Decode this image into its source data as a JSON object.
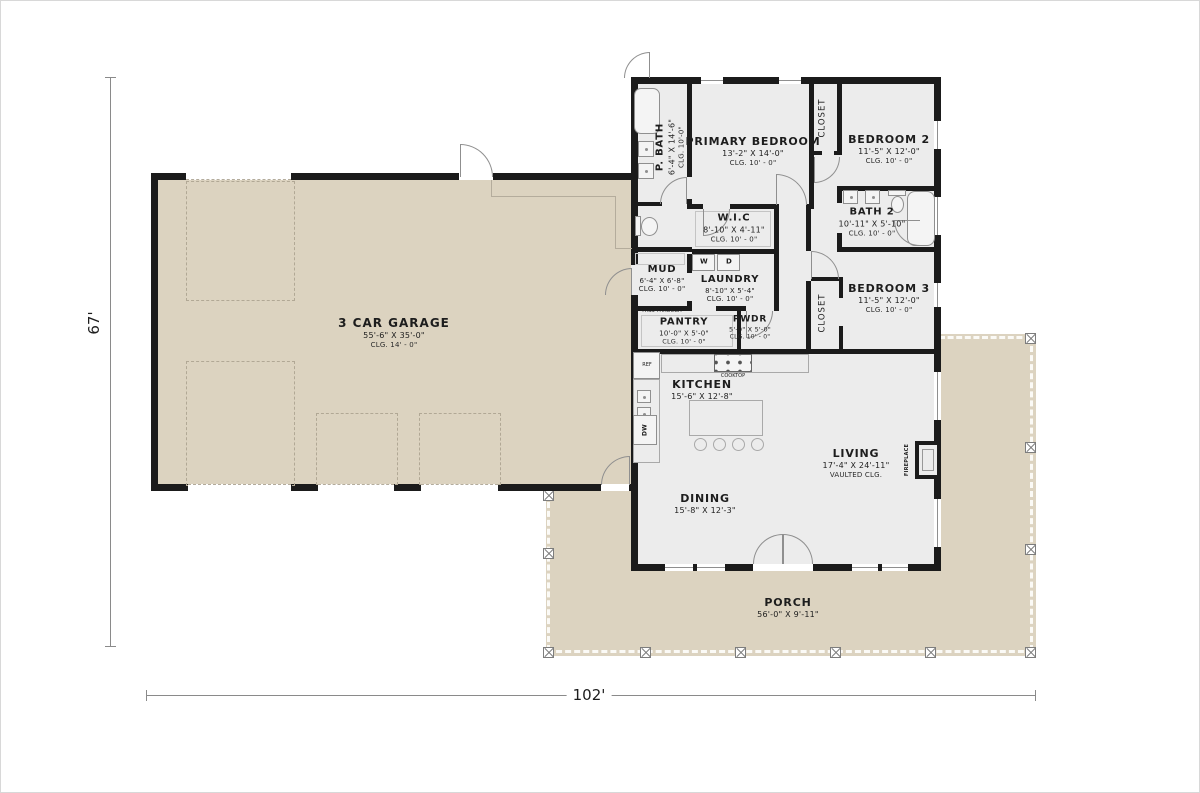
{
  "colors": {
    "wall": "#1b1b1b",
    "garage_fill": "#dcd3c0",
    "house_fill": "#ececec",
    "porch_fill": "#dcd3c0",
    "fixture_line": "#8f8f8f"
  },
  "dimensions": {
    "height_label": "67'",
    "width_label": "102'"
  },
  "rooms": {
    "garage": {
      "name": "3 CAR GARAGE",
      "size": "55'-6\" X 35'-0\"",
      "ceiling": "CLG. 14' - 0\""
    },
    "primary_bedroom": {
      "name": "PRIMARY BEDROOM",
      "size": "13'-2\" X 14'-0\"",
      "ceiling": "CLG. 10' - 0\""
    },
    "p_bath": {
      "name": "P. BATH",
      "size": "6'-4\" X 14'-6\"",
      "ceiling": "CLG. 10'-0\""
    },
    "closet_bed2": {
      "name": "CLOSET"
    },
    "bedroom2": {
      "name": "BEDROOM 2",
      "size": "11'-5\" X 12'-0\"",
      "ceiling": "CLG. 10' - 0\""
    },
    "wic": {
      "name": "W.I.C",
      "size": "8'-10\" X 4'-11\"",
      "ceiling": "CLG. 10' - 0\""
    },
    "bath2": {
      "name": "BATH 2",
      "size": "10'-11\" X 5'-10\"",
      "ceiling": "CLG. 10' - 0\""
    },
    "mud": {
      "name": "MUD",
      "size": "6'-4\" X 6'-8\"",
      "ceiling": "CLG. 10' - 0\""
    },
    "laundry": {
      "name": "LAUNDRY",
      "size": "8'-10\" X 5'-4\"",
      "ceiling": "CLG. 10' - 0\""
    },
    "bedroom3": {
      "name": "BEDROOM 3",
      "size": "11'-5\" X 12'-0\"",
      "ceiling": "CLG. 10' - 0\""
    },
    "closet_bed3": {
      "name": "CLOSET"
    },
    "pantry": {
      "name": "PANTRY",
      "size": "10'-0\" X 5'-0\"",
      "ceiling": "CLG. 10' - 0\""
    },
    "pwdr": {
      "name": "PWDR",
      "size": "5'-0\" X 5'-0\"",
      "ceiling": "CLG. 10' - 0\""
    },
    "kitchen": {
      "name": "KITCHEN",
      "size": "15'-6\" X 12'-8\""
    },
    "living": {
      "name": "LIVING",
      "size": "17'-4\" X 24'-11\"",
      "ceiling": "VAULTED CLG."
    },
    "dining": {
      "name": "DINING",
      "size": "15'-8\" X 12'-3\""
    },
    "porch": {
      "name": "PORCH",
      "size": "56'-0\" X 9'-11\""
    }
  },
  "fixtures": {
    "fireplace": "FIREPLACE",
    "cooktop": "COOKTOP",
    "refrigerator": "REF",
    "dishwasher": "DW",
    "washer": "W",
    "dryer": "D",
    "pass_through": "PASS THROUGH"
  }
}
